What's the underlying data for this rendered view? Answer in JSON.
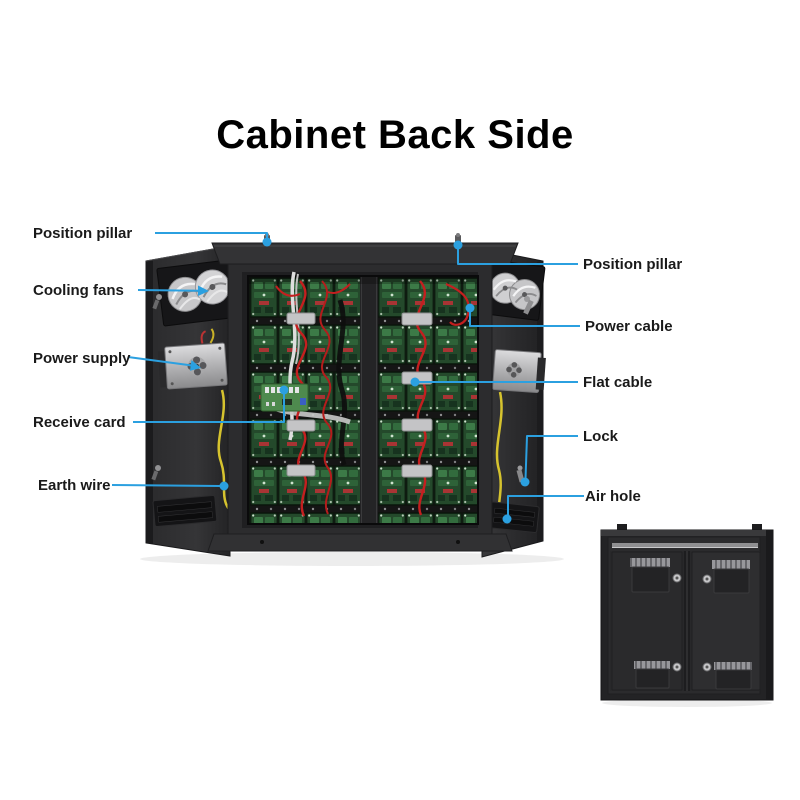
{
  "title": "Cabinet Back Side",
  "colors": {
    "accent": "#2ba0e0",
    "text": "#1a1a1a"
  },
  "labels": {
    "left": [
      {
        "text": "Position pillar"
      },
      {
        "text": "Cooling fans"
      },
      {
        "text": "Power supply"
      },
      {
        "text": "Receive card"
      },
      {
        "text": "Earth wire"
      }
    ],
    "right": [
      {
        "text": "Position pillar"
      },
      {
        "text": "Power cable"
      },
      {
        "text": "Flat cable"
      },
      {
        "text": "Lock"
      },
      {
        "text": "Air hole"
      }
    ]
  }
}
